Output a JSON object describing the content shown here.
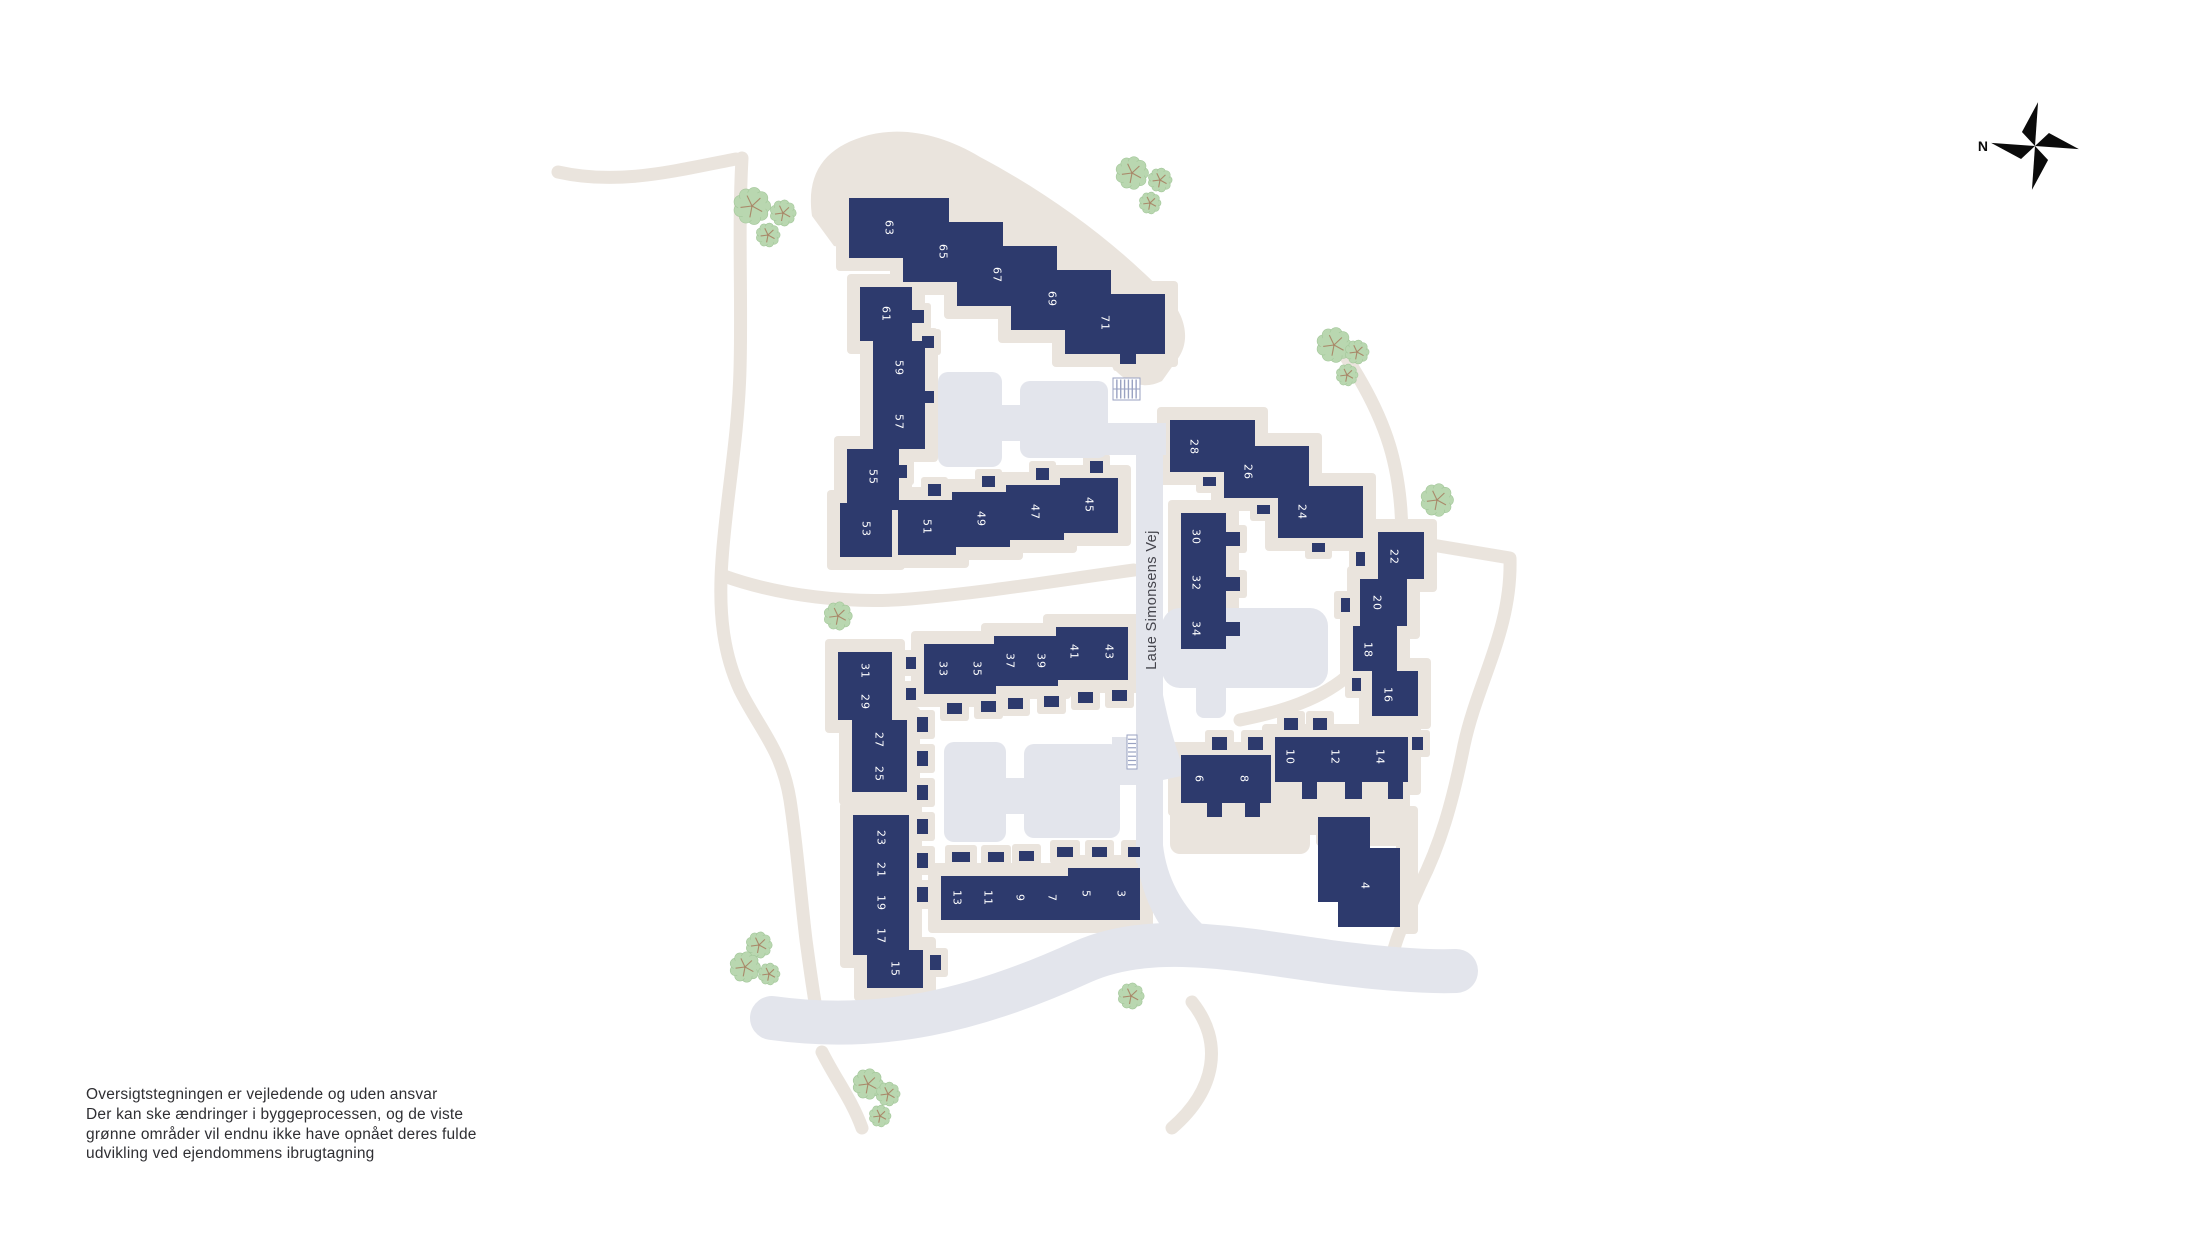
{
  "page": {
    "background": "#ffffff"
  },
  "colors": {
    "building": "#2d3a6d",
    "plot_beige": "#eae4dd",
    "road_gray": "#e3e5ec",
    "tree_fill": "#b9d7b0",
    "tree_edge": "#a3c79a",
    "tree_branch": "#a9896a",
    "label_text": "#ffffff",
    "street_text": "#44444c",
    "compass": "#0b0b0b"
  },
  "compass": {
    "north_label": "N"
  },
  "street": {
    "label": "Laue Simonsens Vej"
  },
  "disclaimer": {
    "lines": [
      "Oversigtstegningen er vejledende og uden ansvar",
      "Der kan ske ændringer i byggeprocessen, og de viste",
      "grønne områder vil endnu ikke have opnået deres fulde",
      "udvikling ved ejendommens ibrugtagning"
    ]
  },
  "map": {
    "buildings": [
      {
        "n": "63",
        "x": 849,
        "y": 198,
        "w": 100,
        "h": 60,
        "lx": 889,
        "ly": 228
      },
      {
        "n": "65",
        "x": 903,
        "y": 222,
        "w": 100,
        "h": 60,
        "lx": 943,
        "ly": 252
      },
      {
        "n": "67",
        "x": 957,
        "y": 246,
        "w": 100,
        "h": 60,
        "lx": 997,
        "ly": 275
      },
      {
        "n": "69",
        "x": 1011,
        "y": 270,
        "w": 100,
        "h": 60,
        "lx": 1052,
        "ly": 299
      },
      {
        "n": "71",
        "x": 1065,
        "y": 294,
        "w": 100,
        "h": 60,
        "lx": 1105,
        "ly": 323
      },
      {
        "n": "61",
        "x": 860,
        "y": 287,
        "w": 52,
        "h": 54,
        "lx": 886,
        "ly": 314
      },
      {
        "n": "59",
        "x": 873,
        "y": 341,
        "w": 52,
        "h": 54,
        "lx": 899,
        "ly": 368
      },
      {
        "n": "57",
        "x": 873,
        "y": 395,
        "w": 52,
        "h": 54,
        "lx": 899,
        "ly": 422
      },
      {
        "n": "55",
        "x": 847,
        "y": 449,
        "w": 52,
        "h": 54,
        "lx": 873,
        "ly": 477
      },
      {
        "n": "53",
        "x": 840,
        "y": 503,
        "w": 52,
        "h": 54,
        "lx": 866,
        "ly": 529
      },
      {
        "n": "51",
        "x": 898,
        "y": 500,
        "w": 58,
        "h": 55,
        "lx": 927,
        "ly": 527
      },
      {
        "n": "49",
        "x": 952,
        "y": 492,
        "w": 58,
        "h": 55,
        "lx": 981,
        "ly": 519
      },
      {
        "n": "47",
        "x": 1006,
        "y": 485,
        "w": 58,
        "h": 55,
        "lx": 1035,
        "ly": 512
      },
      {
        "n": "45",
        "x": 1060,
        "y": 478,
        "w": 58,
        "h": 55,
        "lx": 1089,
        "ly": 505
      },
      {
        "n": "28",
        "x": 1170,
        "y": 420,
        "w": 85,
        "h": 52,
        "lx": 1194,
        "ly": 447
      },
      {
        "n": "26",
        "x": 1224,
        "y": 446,
        "w": 85,
        "h": 52,
        "lx": 1248,
        "ly": 472
      },
      {
        "n": "24",
        "x": 1278,
        "y": 486,
        "w": 85,
        "h": 52,
        "lx": 1302,
        "ly": 512
      },
      {
        "n": "30",
        "x": 1181,
        "y": 513,
        "w": 45,
        "h": 45,
        "lx": 1196,
        "ly": 537
      },
      {
        "n": "32",
        "x": 1181,
        "y": 558,
        "w": 45,
        "h": 45,
        "lx": 1196,
        "ly": 583
      },
      {
        "n": "34",
        "x": 1181,
        "y": 603,
        "w": 45,
        "h": 46,
        "lx": 1196,
        "ly": 629
      },
      {
        "n": "22",
        "x": 1378,
        "y": 532,
        "w": 46,
        "h": 47,
        "lx": 1394,
        "ly": 557
      },
      {
        "n": "20",
        "x": 1360,
        "y": 579,
        "w": 47,
        "h": 47,
        "lx": 1377,
        "ly": 603
      },
      {
        "n": "18",
        "x": 1353,
        "y": 626,
        "w": 44,
        "h": 45,
        "lx": 1368,
        "ly": 650
      },
      {
        "n": "16",
        "x": 1372,
        "y": 671,
        "w": 46,
        "h": 45,
        "lx": 1388,
        "ly": 695
      },
      {
        "n": "6",
        "x": 1181,
        "y": 755,
        "w": 45,
        "h": 48,
        "lx": 1199,
        "ly": 779
      },
      {
        "n": "8",
        "x": 1226,
        "y": 755,
        "w": 45,
        "h": 48,
        "lx": 1244,
        "ly": 779
      },
      {
        "n": "10",
        "x": 1275,
        "y": 737,
        "w": 45,
        "h": 45,
        "lx": 1290,
        "ly": 757
      },
      {
        "n": "12",
        "x": 1320,
        "y": 737,
        "w": 45,
        "h": 45,
        "lx": 1335,
        "ly": 757
      },
      {
        "n": "14",
        "x": 1365,
        "y": 737,
        "w": 43,
        "h": 45,
        "lx": 1380,
        "ly": 757
      },
      {
        "n": "4",
        "poly": [
          [
            1318,
            817
          ],
          [
            1370,
            817
          ],
          [
            1370,
            848
          ],
          [
            1400,
            848
          ],
          [
            1400,
            927
          ],
          [
            1338,
            927
          ],
          [
            1338,
            902
          ],
          [
            1318,
            902
          ]
        ],
        "lx": 1365,
        "ly": 886
      },
      {
        "n": "31",
        "x": 838,
        "y": 652,
        "w": 54,
        "h": 34,
        "lx": 865,
        "ly": 671
      },
      {
        "n": "29",
        "x": 838,
        "y": 686,
        "w": 54,
        "h": 34,
        "lx": 865,
        "ly": 702
      },
      {
        "n": "27",
        "x": 852,
        "y": 720,
        "w": 55,
        "h": 36,
        "lx": 879,
        "ly": 740
      },
      {
        "n": "25",
        "x": 852,
        "y": 756,
        "w": 55,
        "h": 36,
        "lx": 879,
        "ly": 774
      },
      {
        "n": "23",
        "x": 853,
        "y": 815,
        "w": 56,
        "h": 35,
        "lx": 881,
        "ly": 838
      },
      {
        "n": "21",
        "x": 853,
        "y": 850,
        "w": 56,
        "h": 35,
        "lx": 881,
        "ly": 870
      },
      {
        "n": "19",
        "x": 853,
        "y": 885,
        "w": 56,
        "h": 35,
        "lx": 881,
        "ly": 903
      },
      {
        "n": "17",
        "x": 853,
        "y": 920,
        "w": 56,
        "h": 35,
        "lx": 881,
        "ly": 936
      },
      {
        "n": "15",
        "x": 867,
        "y": 950,
        "w": 56,
        "h": 38,
        "lx": 895,
        "ly": 969
      },
      {
        "n": "33",
        "x": 924,
        "y": 644,
        "w": 36,
        "h": 50,
        "lx": 943,
        "ly": 669
      },
      {
        "n": "35",
        "x": 960,
        "y": 644,
        "w": 36,
        "h": 50,
        "lx": 977,
        "ly": 669
      },
      {
        "n": "37",
        "x": 994,
        "y": 636,
        "w": 32,
        "h": 50,
        "lx": 1010,
        "ly": 661
      },
      {
        "n": "39",
        "x": 1026,
        "y": 636,
        "w": 32,
        "h": 50,
        "lx": 1041,
        "ly": 661
      },
      {
        "n": "41",
        "x": 1056,
        "y": 627,
        "w": 36,
        "h": 53,
        "lx": 1074,
        "ly": 652
      },
      {
        "n": "43",
        "x": 1092,
        "y": 627,
        "w": 36,
        "h": 53,
        "lx": 1109,
        "ly": 652
      },
      {
        "n": "13",
        "x": 941,
        "y": 876,
        "w": 32,
        "h": 44,
        "lx": 957,
        "ly": 898
      },
      {
        "n": "11",
        "x": 973,
        "y": 876,
        "w": 32,
        "h": 44,
        "lx": 988,
        "ly": 898
      },
      {
        "n": "9",
        "x": 1005,
        "y": 876,
        "w": 32,
        "h": 44,
        "lx": 1020,
        "ly": 898
      },
      {
        "n": "7",
        "x": 1037,
        "y": 876,
        "w": 31,
        "h": 44,
        "lx": 1052,
        "ly": 898
      },
      {
        "n": "5",
        "x": 1068,
        "y": 868,
        "w": 36,
        "h": 52,
        "lx": 1086,
        "ly": 894
      },
      {
        "n": "3",
        "x": 1104,
        "y": 868,
        "w": 36,
        "h": 52,
        "lx": 1121,
        "ly": 894
      }
    ],
    "sheds": [
      [
        904,
        256,
        16,
        12
      ],
      [
        958,
        280,
        16,
        12
      ],
      [
        1012,
        304,
        16,
        12
      ],
      [
        1066,
        328,
        16,
        12
      ],
      [
        1120,
        352,
        16,
        12
      ],
      [
        912,
        310,
        12,
        13
      ],
      [
        922,
        336,
        12,
        12
      ],
      [
        924,
        391,
        10,
        12
      ],
      [
        897,
        465,
        10,
        13
      ],
      [
        888,
        497,
        10,
        13
      ],
      [
        928,
        484,
        13,
        12
      ],
      [
        982,
        476,
        13,
        11
      ],
      [
        1036,
        468,
        13,
        12
      ],
      [
        1090,
        461,
        13,
        12
      ],
      [
        947,
        703,
        15,
        11
      ],
      [
        981,
        701,
        15,
        11
      ],
      [
        1008,
        698,
        15,
        11
      ],
      [
        1044,
        696,
        15,
        11
      ],
      [
        1078,
        692,
        15,
        11
      ],
      [
        1112,
        690,
        15,
        11
      ],
      [
        906,
        657,
        10,
        12
      ],
      [
        906,
        688,
        10,
        12
      ],
      [
        917,
        717,
        11,
        15
      ],
      [
        917,
        751,
        11,
        15
      ],
      [
        917,
        785,
        11,
        15
      ],
      [
        917,
        819,
        11,
        15
      ],
      [
        917,
        853,
        11,
        15
      ],
      [
        917,
        887,
        11,
        15
      ],
      [
        930,
        955,
        11,
        15
      ],
      [
        952,
        852,
        18,
        10
      ],
      [
        988,
        852,
        16,
        10
      ],
      [
        1019,
        851,
        15,
        10
      ],
      [
        1057,
        847,
        16,
        10
      ],
      [
        1092,
        847,
        15,
        10
      ],
      [
        1128,
        847,
        12,
        10
      ],
      [
        1203,
        477,
        13,
        9
      ],
      [
        1257,
        505,
        13,
        9
      ],
      [
        1312,
        543,
        13,
        9
      ],
      [
        1356,
        552,
        9,
        14
      ],
      [
        1341,
        598,
        9,
        14
      ],
      [
        1352,
        678,
        9,
        13
      ],
      [
        1212,
        737,
        15,
        13
      ],
      [
        1248,
        737,
        15,
        13
      ],
      [
        1284,
        718,
        14,
        12
      ],
      [
        1313,
        718,
        14,
        12
      ],
      [
        1302,
        782,
        15,
        17
      ],
      [
        1345,
        782,
        17,
        17
      ],
      [
        1388,
        782,
        15,
        17
      ],
      [
        1412,
        737,
        11,
        13
      ],
      [
        1226,
        532,
        14,
        14
      ],
      [
        1226,
        577,
        14,
        14
      ],
      [
        1226,
        622,
        14,
        14
      ],
      [
        1207,
        803,
        15,
        14
      ],
      [
        1245,
        803,
        15,
        14
      ]
    ],
    "trees": [
      [
        752,
        206,
        17
      ],
      [
        783,
        213,
        12
      ],
      [
        768,
        235,
        11
      ],
      [
        1132,
        173,
        15
      ],
      [
        1160,
        180,
        11
      ],
      [
        1150,
        203,
        10
      ],
      [
        1334,
        345,
        16
      ],
      [
        1357,
        352,
        11
      ],
      [
        1347,
        375,
        10
      ],
      [
        1437,
        500,
        15
      ],
      [
        838,
        616,
        13
      ],
      [
        759,
        945,
        12
      ],
      [
        745,
        967,
        14
      ],
      [
        769,
        974,
        10
      ],
      [
        1131,
        996,
        12
      ],
      [
        868,
        1084,
        14
      ],
      [
        888,
        1094,
        11
      ],
      [
        880,
        1116,
        10
      ]
    ],
    "bike_racks": [
      {
        "x": 1113,
        "y": 378,
        "w": 27,
        "h": 22,
        "orient": "h"
      },
      {
        "x": 1127,
        "y": 735,
        "w": 10,
        "h": 34,
        "orient": "v"
      }
    ]
  }
}
